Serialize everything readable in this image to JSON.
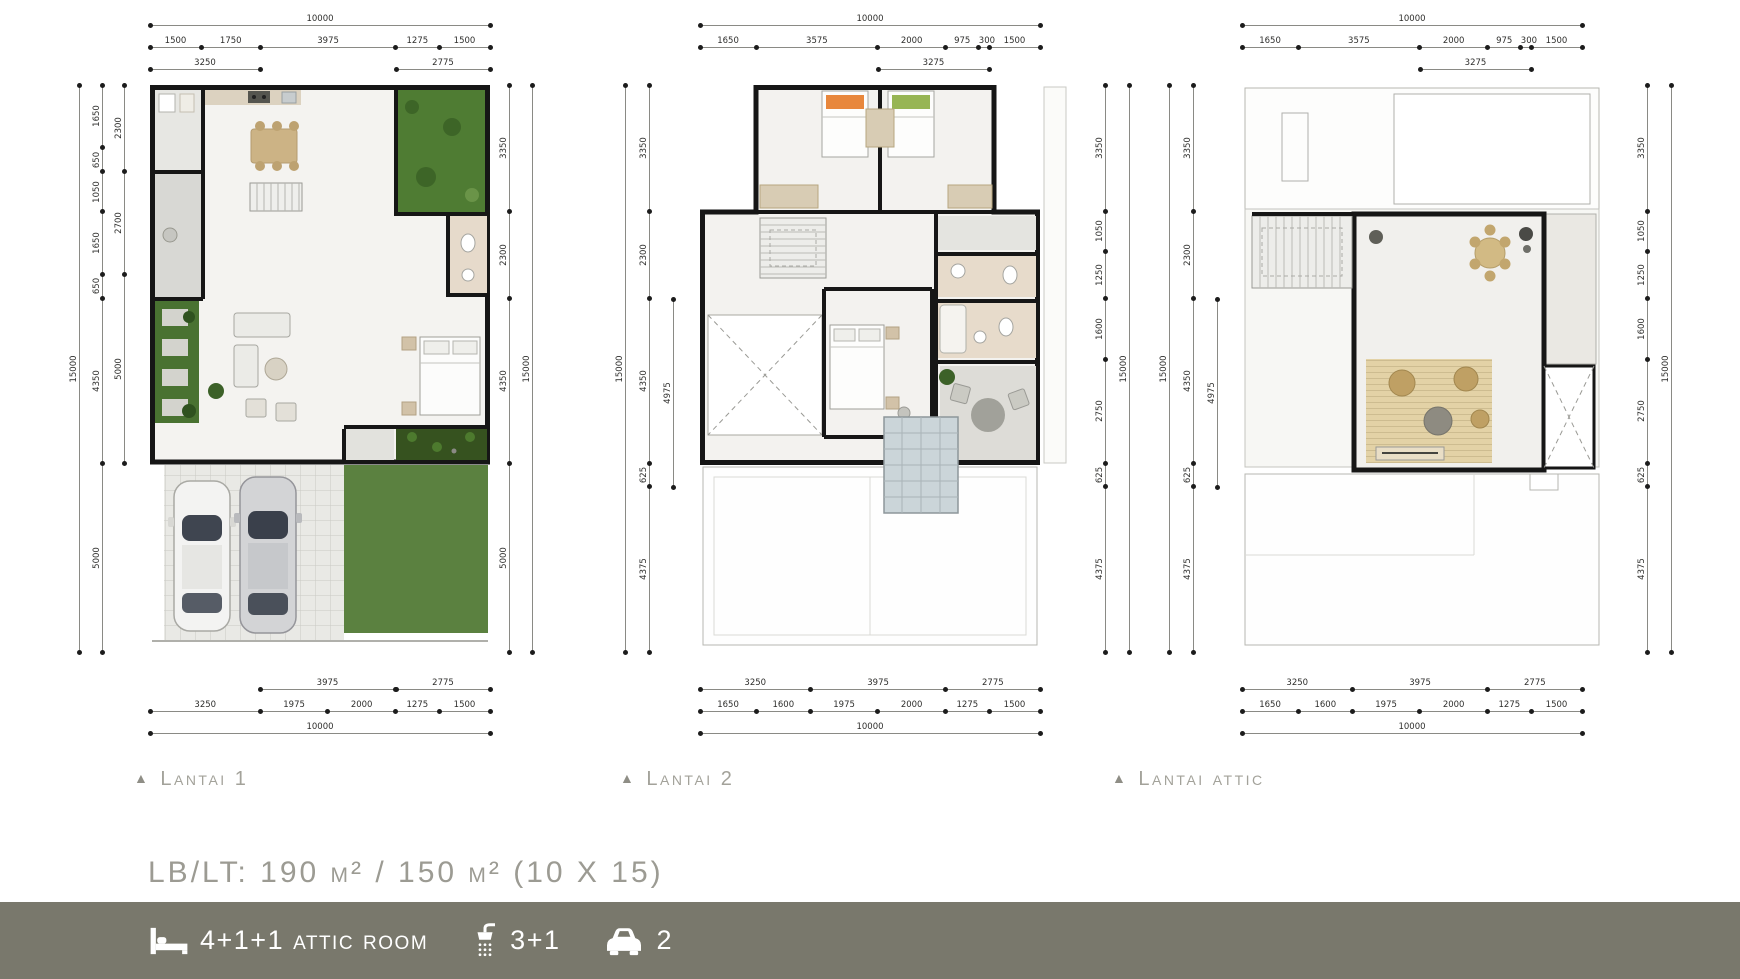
{
  "colors": {
    "footer_bar": "#79786c",
    "label_gray": "#a3a29a",
    "area_text_gray": "#9c9b93",
    "wall_black": "#161616",
    "garden_green": "#4f7c33",
    "dim_text": "#2e2e2c"
  },
  "plans": {
    "p1": {
      "marker": "▲",
      "label": "Lantai 1",
      "dims": {
        "top_total": [
          "10000"
        ],
        "top_segments": [
          "1500",
          "1750",
          "3975",
          "1275",
          "1500"
        ],
        "top_sub_left": [
          "3250"
        ],
        "top_sub_right": [
          "2775"
        ],
        "left_outer": [
          "15000"
        ],
        "left_mid": [
          "1650",
          "650",
          "1050",
          "1650",
          "650",
          "4350",
          "5000"
        ],
        "left_inner": [
          "2300",
          "2700",
          "5000"
        ],
        "right_chain": [
          "3350",
          "2300",
          "4350",
          "5000"
        ],
        "right_outer": [
          "15000"
        ],
        "bottom_sub_mid": [
          "3975"
        ],
        "bottom_sub_right": [
          "2775"
        ],
        "bottom_segments": [
          "3250",
          "1975",
          "2000",
          "1275",
          "1500"
        ],
        "bottom_total": [
          "10000"
        ]
      }
    },
    "p2": {
      "marker": "▲",
      "label": "Lantai 2",
      "dims": {
        "top_total": [
          "10000"
        ],
        "top_segments": [
          "1650",
          "3575",
          "2000",
          "975",
          "300",
          "1500"
        ],
        "top_sub": [
          "3275"
        ],
        "left_outer": [
          "15000"
        ],
        "left_chain": [
          "3350",
          "2300",
          "4350",
          "625",
          "4375"
        ],
        "left_inner": [
          "4975"
        ],
        "right_chain": [
          "3350",
          "1050",
          "1250",
          "1600",
          "2750",
          "625",
          "4375"
        ],
        "right_outer": [
          "15000"
        ],
        "bottom_sub": [
          "3250",
          "3975",
          "2775"
        ],
        "bottom_segments": [
          "1650",
          "1600",
          "1975",
          "2000",
          "1275",
          "1500"
        ],
        "bottom_total": [
          "10000"
        ]
      }
    },
    "p3": {
      "marker": "▲",
      "label": "Lantai attic",
      "dims": {
        "top_total": [
          "10000"
        ],
        "top_segments": [
          "1650",
          "3575",
          "2000",
          "975",
          "300",
          "1500"
        ],
        "top_sub": [
          "3275"
        ],
        "left_outer": [
          "15000"
        ],
        "left_chain": [
          "3350",
          "2300",
          "4350",
          "625",
          "4375"
        ],
        "left_inner": [
          "4975"
        ],
        "right_chain": [
          "3350",
          "1050",
          "1250",
          "1600",
          "2750",
          "625",
          "4375"
        ],
        "right_outer": [
          "15000"
        ],
        "bottom_sub": [
          "3250",
          "3975",
          "2775"
        ],
        "bottom_segments": [
          "1650",
          "1600",
          "1975",
          "2000",
          "1275",
          "1500"
        ],
        "bottom_total": [
          "10000"
        ]
      }
    }
  },
  "summary": {
    "area_line": "LB/LT: 190 m² / 150 m²  (10 X 15)"
  },
  "footer": {
    "bed_label": "4+1+1 attic room",
    "bath_label": "3+1",
    "car_label": "2"
  }
}
